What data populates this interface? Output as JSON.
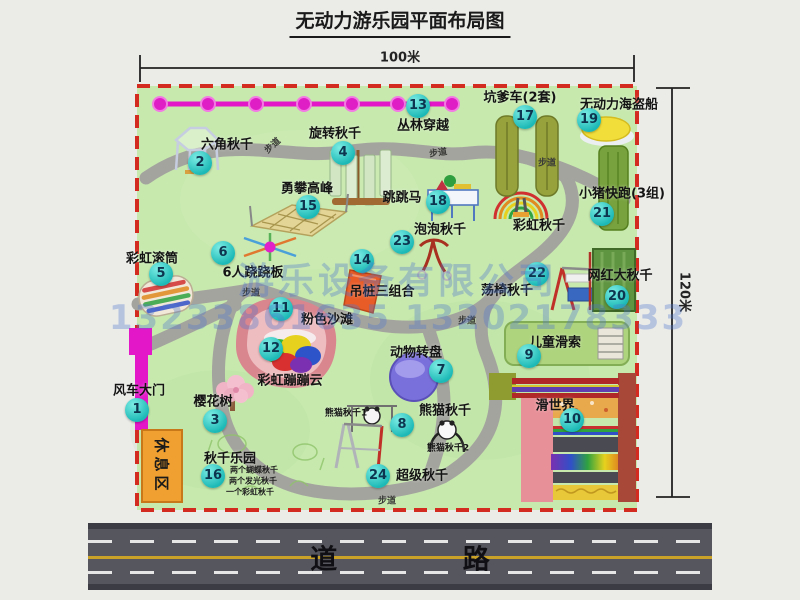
{
  "title": "无动力游乐园平面布局图",
  "dimensions": {
    "width": "100米",
    "height": "120米"
  },
  "road_label": "道 路",
  "path_label": "步道",
  "rest_area_label": "休息区",
  "watermark": {
    "company": "游乐设备有限公司",
    "phone": "13233861635 13202178333"
  },
  "extra_labels": {
    "rainbow_swing": "彩虹秋千",
    "panda_swing_1": "熊猫秋千1",
    "panda_swing_2": "熊猫秋千2"
  },
  "attractions": [
    {
      "num": "1",
      "name": "风车大门"
    },
    {
      "num": "2",
      "name": "六角秋千"
    },
    {
      "num": "3",
      "name": "樱花树"
    },
    {
      "num": "4",
      "name": "旋转秋千"
    },
    {
      "num": "5",
      "name": "彩虹滚筒"
    },
    {
      "num": "6",
      "name": "6人跷跷板"
    },
    {
      "num": "7",
      "name": "动物转盘"
    },
    {
      "num": "8",
      "name": "熊猫秋千"
    },
    {
      "num": "9",
      "name": "儿童滑索"
    },
    {
      "num": "10",
      "name": "滑世界"
    },
    {
      "num": "11",
      "name": "粉色沙滩"
    },
    {
      "num": "12",
      "name": "彩虹蹦蹦云"
    },
    {
      "num": "13",
      "name": "丛林穿越"
    },
    {
      "num": "14",
      "name": "吊桩三组合"
    },
    {
      "num": "15",
      "name": "勇攀高峰"
    },
    {
      "num": "16",
      "name": "秋千乐园",
      "notes": [
        "两个蝴蝶秋千",
        "两个发光秋千",
        "一个彩虹秋千"
      ]
    },
    {
      "num": "17",
      "name": "坑爹车(2套)"
    },
    {
      "num": "18",
      "name": "跳跳马"
    },
    {
      "num": "19",
      "name": "无动力海盗船"
    },
    {
      "num": "20",
      "name": "网红大秋千"
    },
    {
      "num": "21",
      "name": "小猪快跑(3组)"
    },
    {
      "num": "22",
      "name": "荡椅秋千"
    },
    {
      "num": "23",
      "name": "泡泡秋千"
    },
    {
      "num": "24",
      "name": "超级秋千"
    }
  ]
}
